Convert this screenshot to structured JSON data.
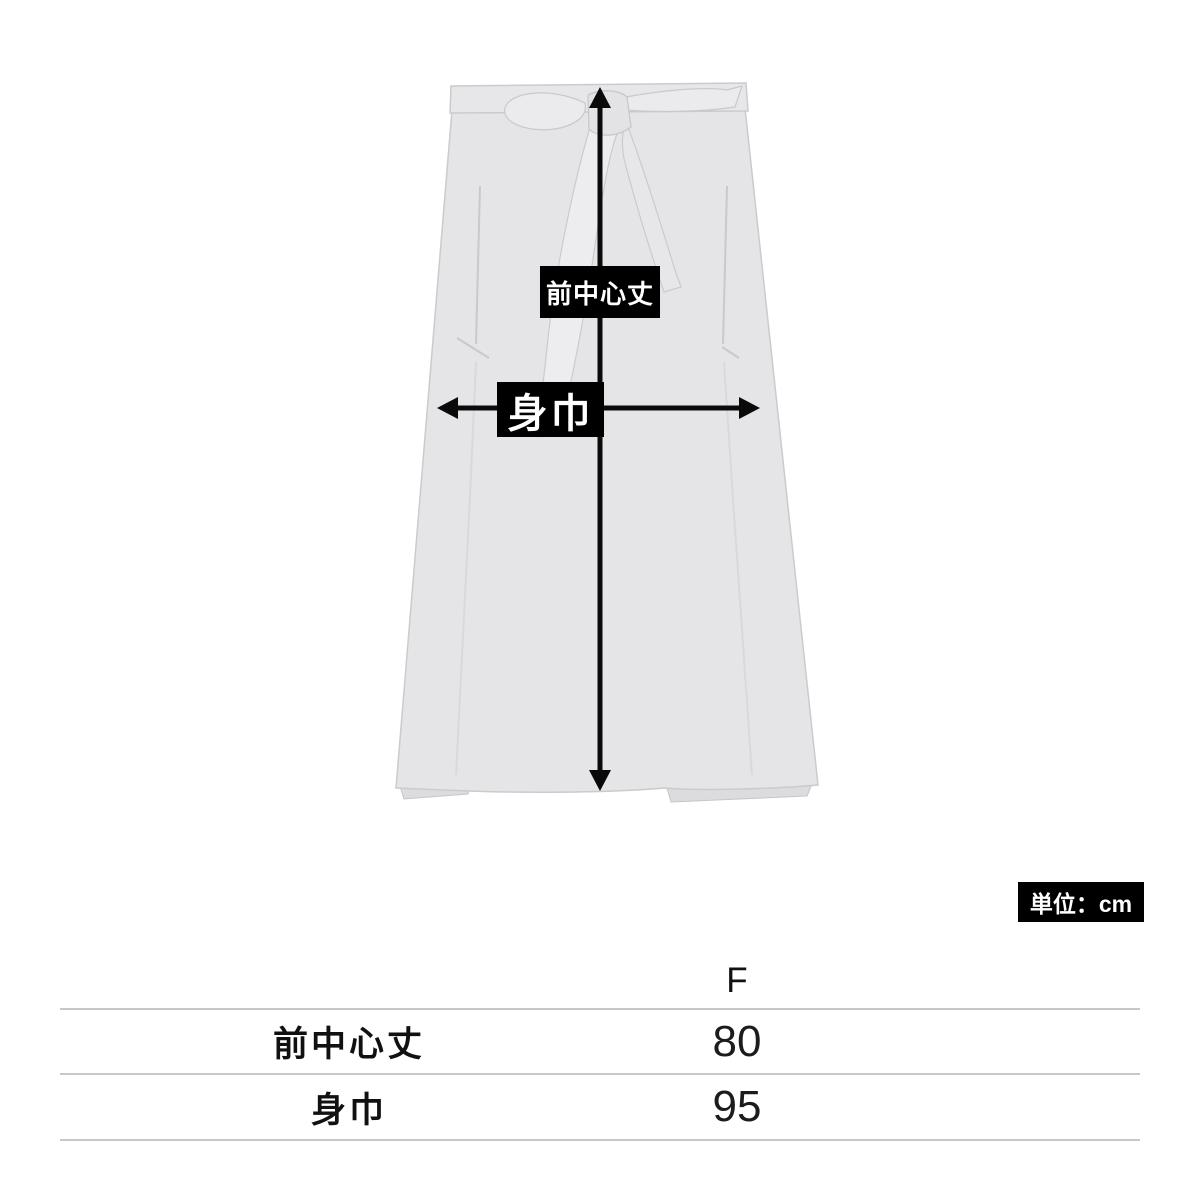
{
  "diagram": {
    "front_center_length_label": "前中心丈",
    "body_width_label": "身巾",
    "unit_label": "単位：cm"
  },
  "size_table": {
    "size_header": "F",
    "rows": [
      {
        "label": "前中心丈",
        "value": "80"
      },
      {
        "label": "身巾",
        "value": "95"
      }
    ]
  },
  "colors": {
    "apron_fill": "#e5e5e7",
    "apron_shadow": "#dcdcde",
    "apron_stroke": "#cbcbce",
    "arrow_black": "#0a0a0a",
    "label_box_bg": "#000000",
    "label_box_text": "#ffffff",
    "table_line": "#c8c8c8"
  }
}
